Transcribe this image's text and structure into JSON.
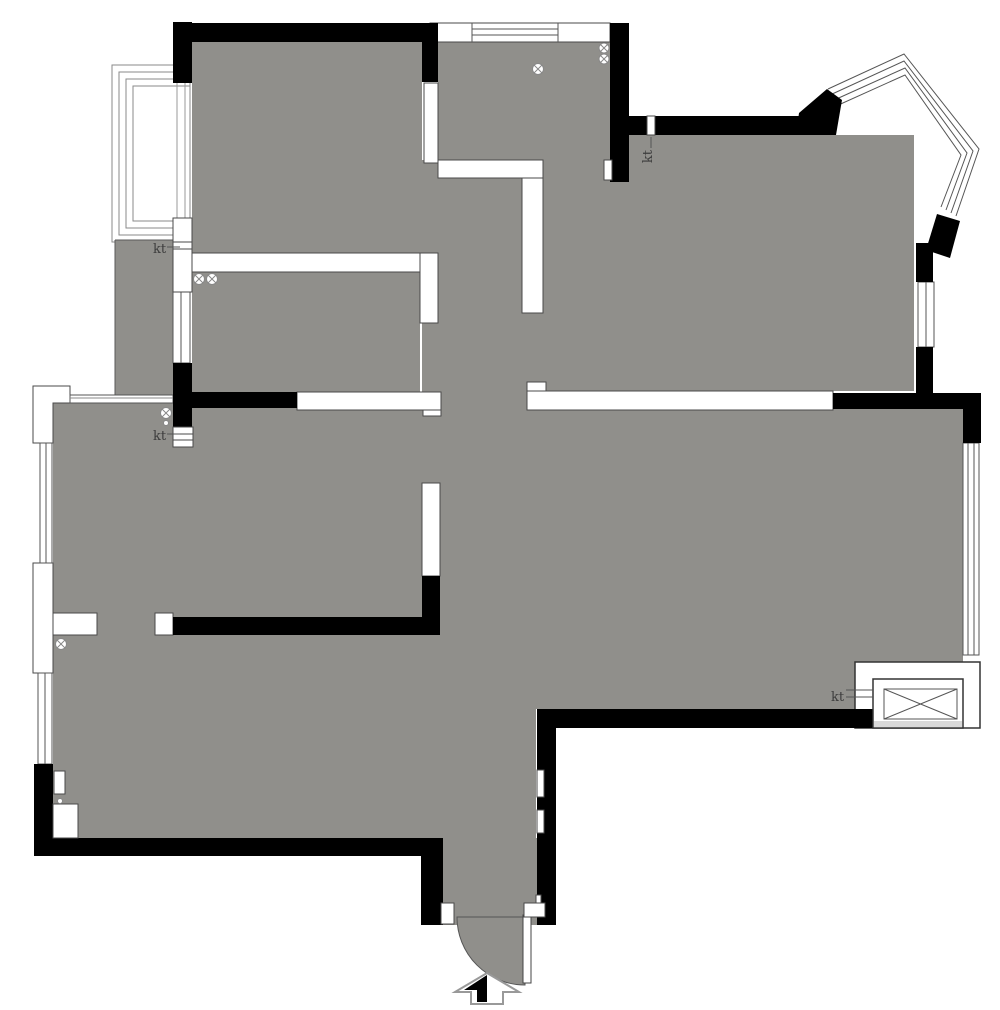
{
  "plan": {
    "type": "apartment-floor-plan",
    "colors": {
      "background": "#ffffff",
      "floor": "#908f8b",
      "wall": "#000000",
      "outline": "#4a4a4a",
      "window_line": "#777777",
      "elevator_strip": "#d9d9d9"
    },
    "labels": {
      "ac_balcony_left": "kt",
      "ac_mid_left": "kt",
      "ac_top_right": "kt",
      "ac_living": "kt"
    },
    "symbols": {
      "circle_x_fixture": {
        "glyph": "circle-with-x",
        "count": 7
      },
      "small_circle_fixture": {
        "glyph": "small-circle",
        "count": 2
      },
      "entry_arrow": {
        "glyph": "half-filled-up-arrow",
        "count": 1
      },
      "elevator_shaft": {
        "glyph": "crossed-box",
        "count": 1
      },
      "entry_door": {
        "glyph": "quarter-circle-swing",
        "count": 1
      }
    }
  }
}
